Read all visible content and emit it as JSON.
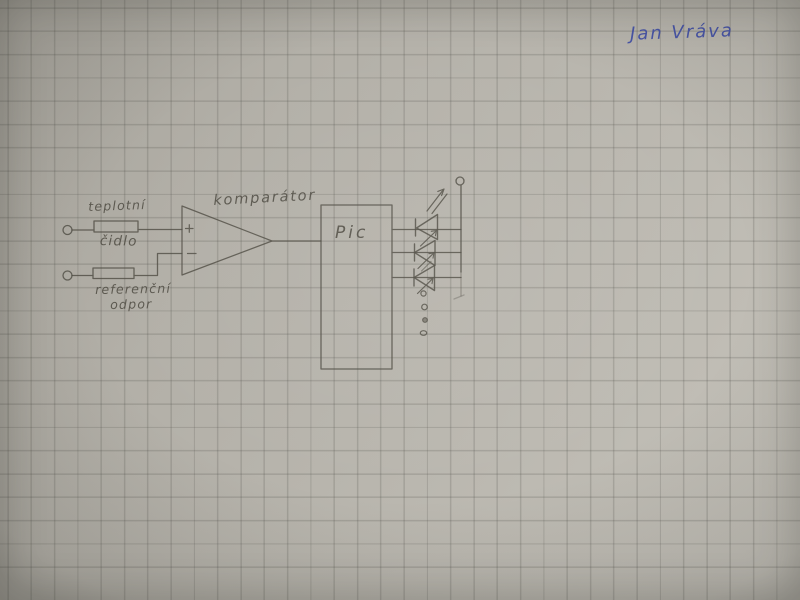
{
  "photo": {
    "paper_color": "#b3b0a8",
    "grid_color": "#9b988f",
    "pencil_color": "#514e45",
    "ink_color": "#4956a8",
    "grid_spacing_px": 23.3
  },
  "signature": {
    "text": "Jan Vráva"
  },
  "diagram": {
    "input_top": {
      "line1": "teplotní",
      "line2": "čidlo"
    },
    "input_bottom": {
      "line1": "referenční",
      "line2": "odpor"
    },
    "comparator": {
      "label": "komparátor",
      "plus": "+",
      "minus": "−"
    },
    "mcu": {
      "label": "Pic"
    },
    "led_row": {
      "led_symbols_drawn": 3,
      "ellipsis_dots": 4
    }
  }
}
